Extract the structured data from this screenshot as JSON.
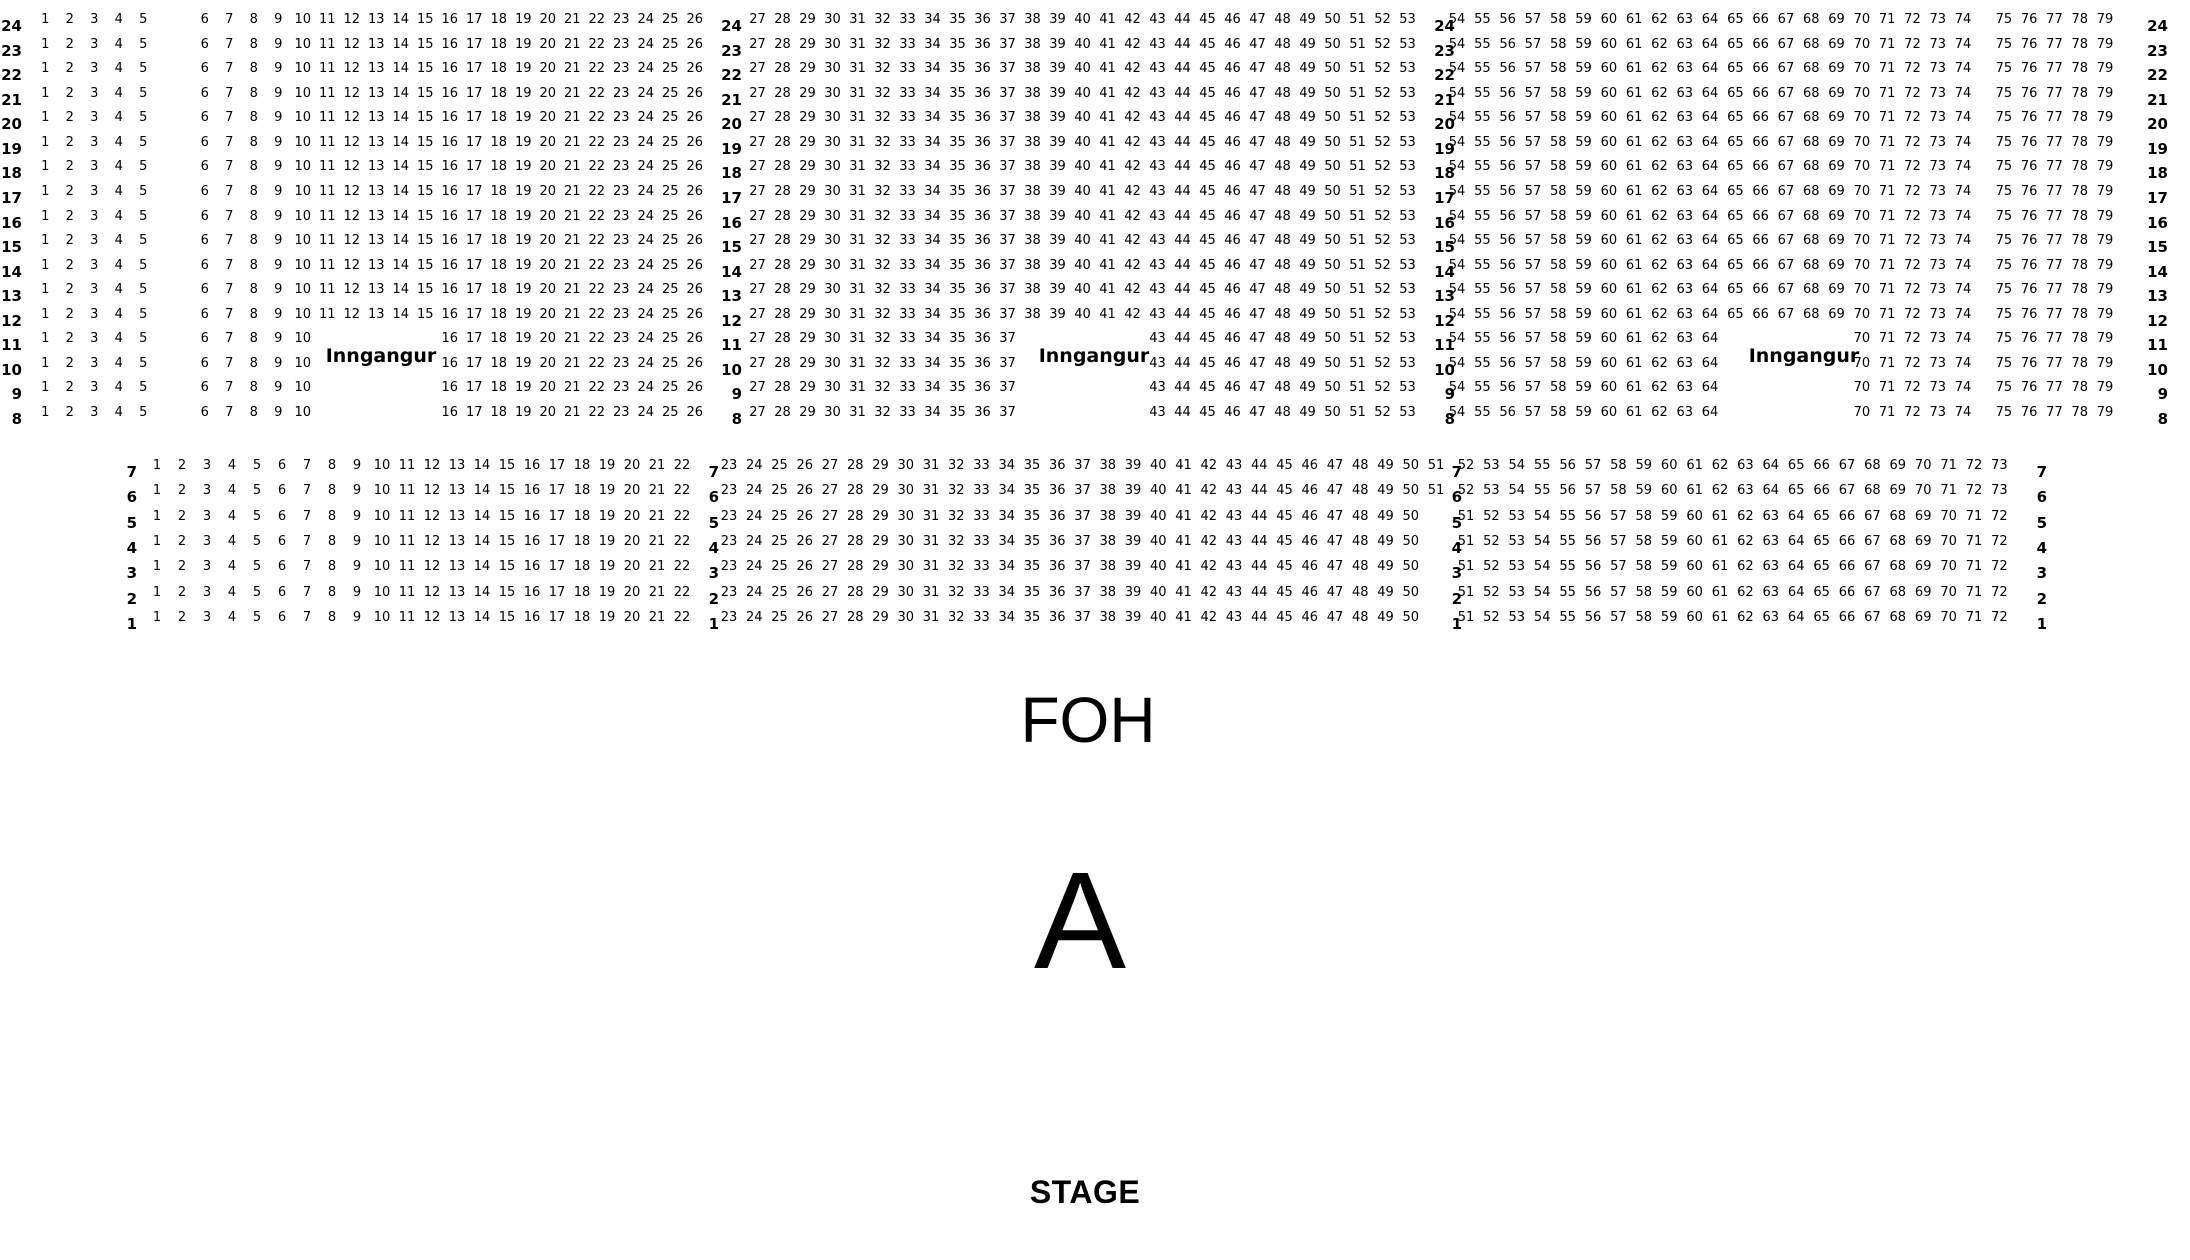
{
  "colors": {
    "background": "#ffffff",
    "text": "#000000"
  },
  "venue": {
    "entrance_label": "Inngangur",
    "foh_label": "FOH",
    "section_label": "A",
    "stage_label": "STAGE"
  },
  "seatmap": {
    "upper_block": {
      "row_types": {
        "full": {
          "origins": {
            "left": 1,
            "middle": 27,
            "right": 54
          },
          "seats": {
            "left": [
              [
                1,
                26
              ]
            ],
            "middle": [
              [
                27,
                53
              ]
            ],
            "right": [
              [
                54,
                79
              ]
            ]
          }
        },
        "entrance": {
          "origins": {
            "left": 1,
            "middle": 27,
            "right": 54
          },
          "seats": {
            "left": [
              [
                1,
                10
              ],
              [
                16,
                26
              ]
            ],
            "middle": [
              [
                27,
                37
              ],
              [
                43,
                53
              ]
            ],
            "right": [
              [
                54,
                64
              ],
              [
                70,
                79
              ]
            ]
          }
        }
      },
      "rows": [
        {
          "label": "24",
          "type": "full"
        },
        {
          "label": "23",
          "type": "full"
        },
        {
          "label": "22",
          "type": "full"
        },
        {
          "label": "21",
          "type": "full"
        },
        {
          "label": "20",
          "type": "full"
        },
        {
          "label": "19",
          "type": "full"
        },
        {
          "label": "18",
          "type": "full"
        },
        {
          "label": "17",
          "type": "full"
        },
        {
          "label": "16",
          "type": "full"
        },
        {
          "label": "15",
          "type": "full"
        },
        {
          "label": "14",
          "type": "full"
        },
        {
          "label": "13",
          "type": "full"
        },
        {
          "label": "12",
          "type": "full"
        },
        {
          "label": "11",
          "type": "entrance",
          "entrance_label": true
        },
        {
          "label": "10",
          "type": "entrance"
        },
        {
          "label": "9",
          "type": "entrance"
        },
        {
          "label": "8",
          "type": "entrance"
        }
      ]
    },
    "lower_block": {
      "row_types": {
        "wide": {
          "origins": {
            "left": 1,
            "middle": 23,
            "right": 52
          },
          "seats": {
            "left": [
              [
                1,
                22
              ]
            ],
            "middle": [
              [
                23,
                51
              ]
            ],
            "right": [
              [
                52,
                73
              ]
            ]
          }
        },
        "narrow": {
          "origins": {
            "left": 1,
            "middle": 23,
            "right": 51
          },
          "seats": {
            "left": [
              [
                1,
                22
              ]
            ],
            "middle": [
              [
                23,
                50
              ]
            ],
            "right": [
              [
                51,
                72
              ]
            ]
          }
        }
      },
      "rows": [
        {
          "label": "7",
          "type": "wide"
        },
        {
          "label": "6",
          "type": "wide"
        },
        {
          "label": "5",
          "type": "narrow"
        },
        {
          "label": "4",
          "type": "narrow"
        },
        {
          "label": "3",
          "type": "narrow"
        },
        {
          "label": "2",
          "type": "narrow"
        },
        {
          "label": "1",
          "type": "narrow"
        }
      ]
    }
  }
}
